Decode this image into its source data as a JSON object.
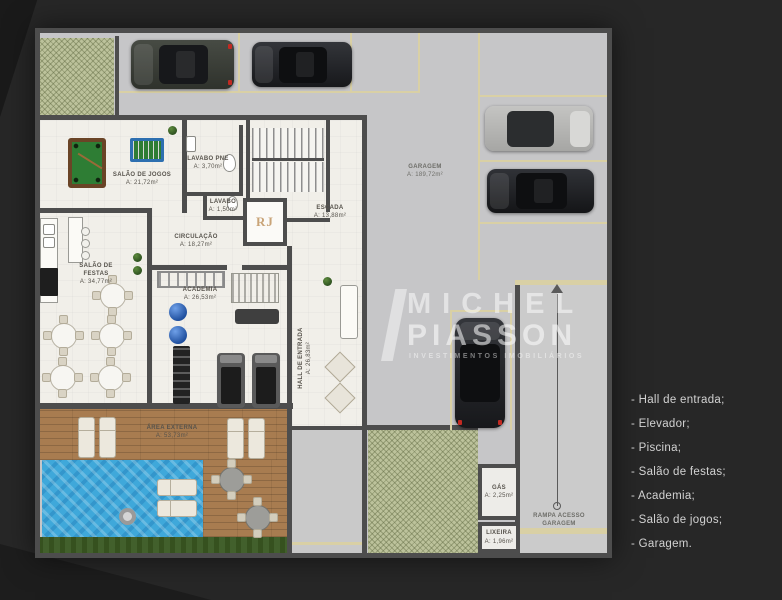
{
  "watermark": {
    "brand_line1": "MICHEL",
    "brand_line2": "PIASSON",
    "tagline": "INVESTIMENTOS IMOBILIÁRIOS"
  },
  "amenities": {
    "items": [
      "- Hall de entrada;",
      "- Elevador;",
      "- Piscina;",
      "- Salão de festas;",
      "- Academia;",
      "- Salão de jogos;",
      "- Garagem."
    ]
  },
  "floorplan": {
    "elevator_logo": "RJ",
    "rooms": [
      {
        "label": "SALÃO DE JOGOS",
        "area": "A: 21,72m²"
      },
      {
        "label": "LAVABO PNE",
        "area": "A: 3,70m²"
      },
      {
        "label": "LAVABO",
        "area": "A: 1,50m²"
      },
      {
        "label": "ESCADA",
        "area": "A: 13,88m²"
      },
      {
        "label": "CIRCULAÇÃO",
        "area": "A: 18,27m²"
      },
      {
        "label": "SALÃO DE FESTAS",
        "area": "A: 34,77m²"
      },
      {
        "label": "ACADEMIA",
        "area": "A: 26,53m²"
      },
      {
        "label": "HALL DE ENTRADA",
        "area": "A: 26,83m²"
      },
      {
        "label": "ÁREA EXTERNA",
        "area": "A: 53,73m²"
      },
      {
        "label": "GARAGEM",
        "area": "A: 189,72m²"
      },
      {
        "label": "GÁS",
        "area": "A: 2,25m²"
      },
      {
        "label": "LIXEIRA",
        "area": "A: 1,96m²"
      },
      {
        "label": "RAMPA ACESSO GARAGEM",
        "area": ""
      }
    ],
    "colors": {
      "wall": "#4d4d4d",
      "garage_floor": "#c6c6c8",
      "interior_floor": "#f1efe9",
      "pool_water": "#3fa8da",
      "wood_deck": "#a87c50",
      "landscape_hatch": "#bcc29b",
      "parking_line": "#d9d0a5",
      "elevator_logo_color": "#c9a478"
    }
  }
}
